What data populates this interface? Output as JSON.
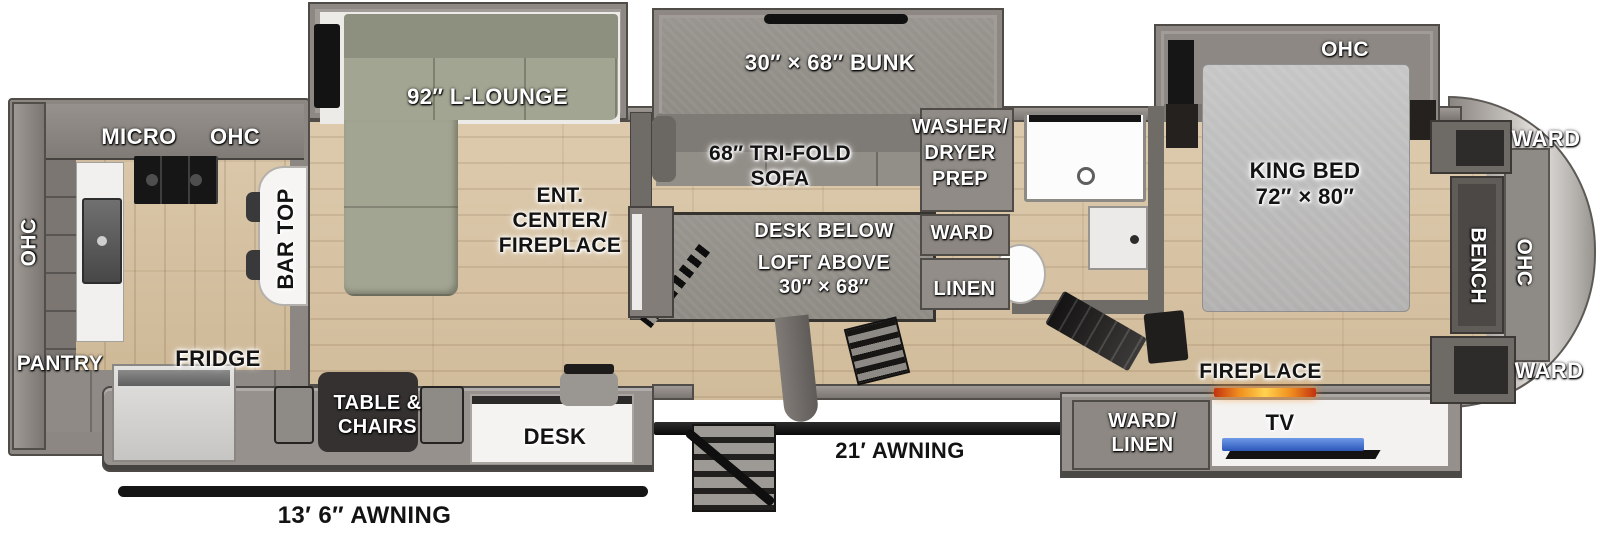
{
  "plan_title": "Fifth wheel RV floor plan",
  "kitchen": {
    "micro": "MICRO",
    "ohc_top": "OHC",
    "ohc_left": "OHC",
    "pantry": "PANTRY",
    "fridge": "FRIDGE",
    "bar_top": "BAR TOP"
  },
  "living": {
    "lounge": "92″ L-LOUNGE",
    "ent_center_lines": [
      "ENT.",
      "CENTER/",
      "FIREPLACE"
    ]
  },
  "bunk_room": {
    "bunk": "30″ × 68″ BUNK",
    "trifold_lines": [
      "68″ TRI-FOLD",
      "SOFA"
    ],
    "desk_below": "DESK BELOW",
    "loft_above_lines": [
      "LOFT ABOVE",
      "30″ × 68″"
    ]
  },
  "utility": {
    "washer_lines": [
      "WASHER/",
      "DRYER",
      "PREP"
    ],
    "ward": "WARD",
    "linen": "LINEN"
  },
  "bedroom": {
    "ohc_slide": "OHC",
    "king_lines": [
      "KING BED",
      "72″ × 80″"
    ],
    "fireplace": "FIREPLACE",
    "tv": "TV",
    "ward_linen_lines": [
      "WARD/",
      "LINEN"
    ],
    "ward_front_top": "WARD",
    "bench": "BENCH",
    "ohc_front": "OHC",
    "ward_front_bottom": "WARD"
  },
  "dinette": {
    "table_lines": [
      "TABLE &",
      "CHAIRS"
    ],
    "desk": "DESK"
  },
  "exterior": {
    "awning_main": "21′ AWNING",
    "awning_left": "13′ 6″ AWNING"
  },
  "colors": {
    "wall_gray": "#8b8681",
    "floor_wood": "#d8c5a6",
    "sofa_sage": "#a3a593",
    "flame_accent": "#f08f1f",
    "tv_screen_blue": "#3a6fd8"
  }
}
